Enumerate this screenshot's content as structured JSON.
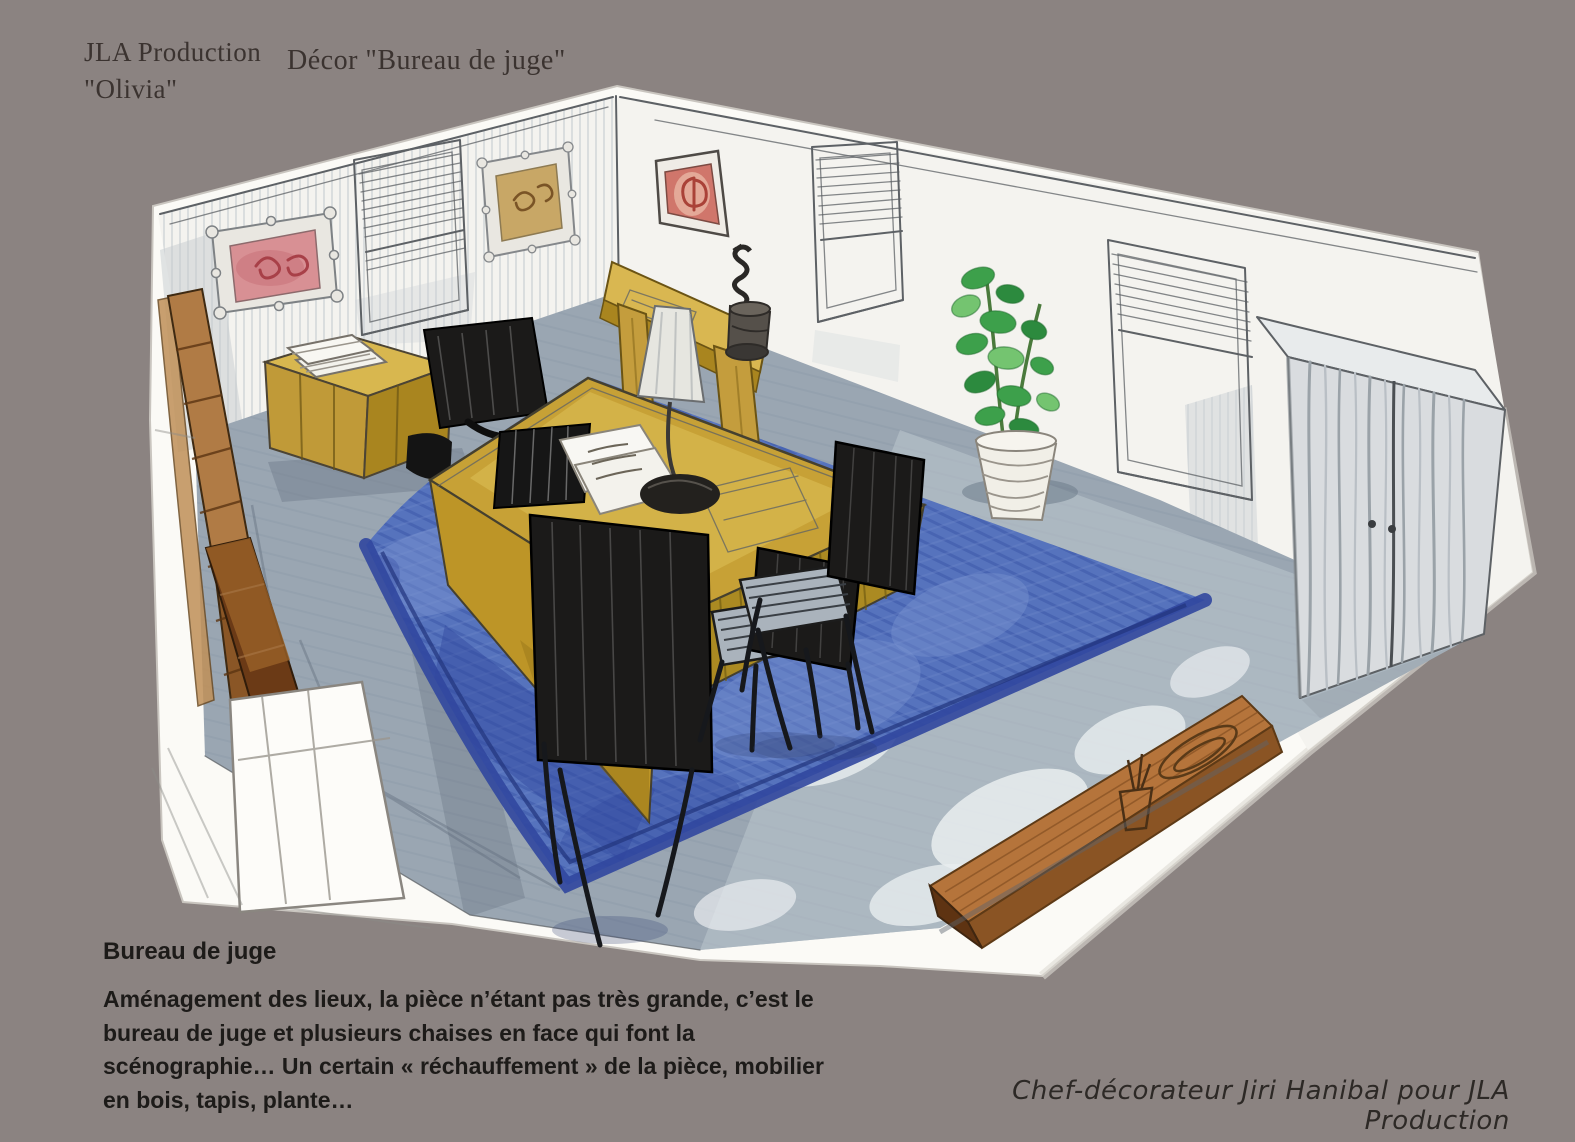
{
  "header": {
    "production": "JLA Production",
    "show": "\"Olivia\"",
    "decor_title": "Décor \"Bureau de juge\""
  },
  "caption": {
    "title": "Bureau de juge",
    "lines": [
      "Aménagement des lieux, la pièce n’étant pas très grande, c’est le",
      "bureau de juge et plusieurs chaises en face qui font la",
      "scénographie… Un certain « réchauffement » de la pièce, mobilier",
      "en bois, tapis, plante…"
    ]
  },
  "credit": "Chef-décorateur Jiri Hanibal pour JLA Production",
  "illustration": {
    "type": "hand-drawn watercolor set-design sketch, aerial corner perspective",
    "objects": [
      "left wall with pink framed picture, window with blinds, gold framed picture",
      "right wall with red framed picture, two windows with blinds, double door",
      "yellow judge desk with lamp, papers and laptop",
      "black high-back office chair",
      "three black visitor chairs",
      "large blue rug on grey floor",
      "low cabinet with white books",
      "console table with small sculpture",
      "green potted plant",
      "wooden bench with dish and small pot",
      "wooden planks along the left wall"
    ]
  },
  "colors": {
    "bg": "#8b8381",
    "paper": "#fbfaf6",
    "wall": "#f4f3ef",
    "wallHatch": "#b9c1c7",
    "pencil": "#5d6165",
    "ink": "#2a2826",
    "floor": "#9aa6b2",
    "floorLight": "#bcc6cd",
    "cloud": "#e9edef",
    "rug": "#5673bd",
    "rugLight": "#7e97d2",
    "rugDark": "#31479e",
    "rugBorder": "#2c418f",
    "desk": "#c7a136",
    "deskLight": "#e3c75f",
    "deskFace": "#bd9527",
    "deskSide": "#ab8a22",
    "cabinetTop": "#d8b74f",
    "cabinetFront": "#c09a38",
    "cabinetSide": "#a9851f",
    "consoleTop": "#d9b751",
    "consoleLeg": "#c49d3d",
    "woodLight": "#b07b45",
    "woodDark": "#8a5626",
    "woodDeep": "#6b3a16",
    "benchTop": "#b5743b",
    "benchSide": "#8a5424",
    "benchEnd": "#5e3312",
    "chair": "#1b1a19",
    "seatSlat": "#aab3bc",
    "plant": "#3da04b",
    "plantDark": "#2c8a3e",
    "plantLight": "#74c470",
    "stem": "#4a7a3c",
    "pot": "#f1efe7",
    "artPink": "#d89094",
    "artPinkInk": "#a84048",
    "artRed": "#d0766b",
    "artRedInk": "#aa4238",
    "artGold": "#c8a766",
    "artGoldInk": "#7a5426",
    "frameLight": "#e9e7e1",
    "door": "#d9dcdf",
    "doorStreak": "#9aa2a8",
    "doorTop": "#e8ebec",
    "shadow": "#6e7b8a",
    "textHeader": "#3b3330",
    "textCaption": "#1d1b19",
    "textCredit": "#2d2926"
  }
}
